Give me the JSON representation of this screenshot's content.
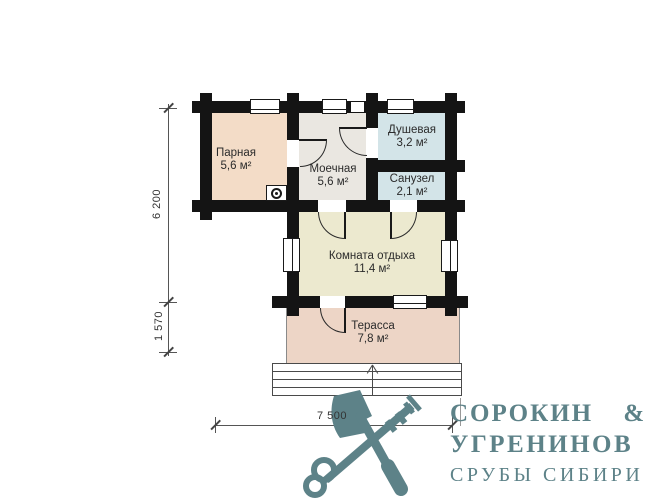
{
  "plan": {
    "title": "bathhouse-floor-plan",
    "rooms": [
      {
        "name": "Парная",
        "area": "5,6 м²"
      },
      {
        "name": "Моечная",
        "area": "5,6 м²"
      },
      {
        "name": "Душевая",
        "area": "3,2 м²"
      },
      {
        "name": "Санузел",
        "area": "2,1 м²"
      },
      {
        "name": "Комната отдыха",
        "area": "11,4 м²"
      },
      {
        "name": "Терасса",
        "area": "7,8 м²"
      }
    ],
    "dimensions": {
      "left_total": "6 200",
      "left_terrace": "1 570",
      "bottom": "7 500"
    },
    "colors": {
      "wall": "#141414",
      "parnaya": "#f3dcc7",
      "moechnaya": "#eae7e1",
      "wet_rooms": "#d3e4e8",
      "rest_room": "#ece9cf",
      "terrace": "#edd5c6"
    }
  },
  "logo": {
    "line1": "СОРОКИН &",
    "line2": "УГРЕНИНОВ",
    "line3": "СРУБЫ СИБИРИ",
    "color": "#5d8288"
  }
}
